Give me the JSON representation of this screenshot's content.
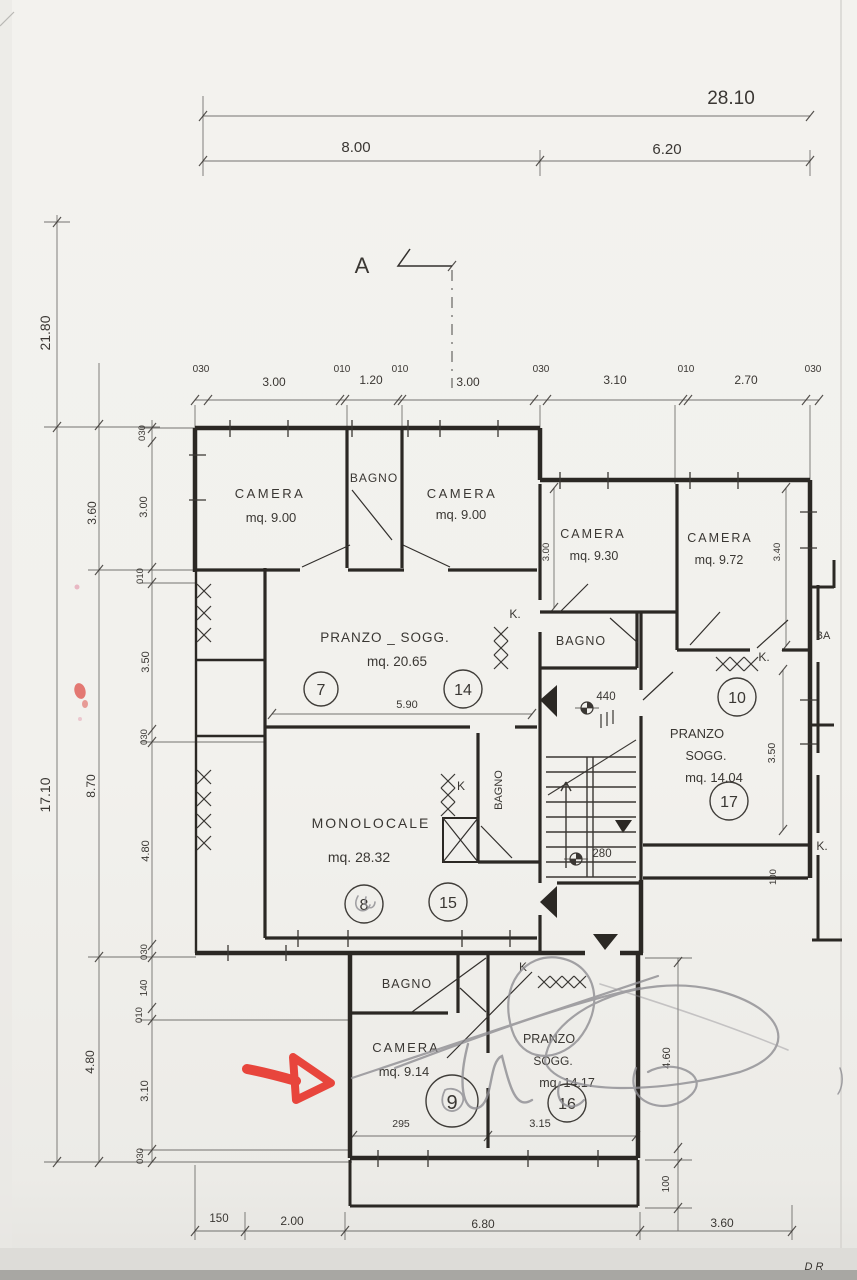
{
  "document": {
    "kind": "Scanned hand-drawn architectural floor plan",
    "language": "Italian"
  },
  "section_marker": "A",
  "dims_top": {
    "total": "28.10",
    "seg_left": "8.00",
    "seg_right": "6.20"
  },
  "dims_top_row": [
    "030",
    "3.00",
    "010",
    "1.20",
    "010",
    "3.00",
    "030",
    "3.10",
    "010",
    "2.70",
    "030"
  ],
  "dims_left_outer": [
    "21.80",
    "17.10"
  ],
  "dims_left_mid": [
    "3.60",
    "8.70",
    "4.80"
  ],
  "dims_left_inner": [
    "030",
    "3.00",
    "010",
    "3.50",
    "030",
    "4.80",
    "030",
    "140",
    "010",
    "3.10",
    "030"
  ],
  "dims_bottom": [
    "150",
    "2.00",
    "6.80",
    "3.60"
  ],
  "dims_right": {
    "camera_ne_h": "3.00",
    "camera_e_h": "3.40",
    "pranzo_e_h": "3.50",
    "strip_h": "100",
    "unit_s_h": "4.60",
    "balcony_s_h": "100"
  },
  "dims_interior": {
    "pranzo_width": "5.90",
    "stair_marker_1": "440",
    "stair_marker_2": "280",
    "camera_s_width": "295",
    "pranzo_s_width": "3.15"
  },
  "rooms": {
    "camera_nw": {
      "name": "CAMERA",
      "area": "mq. 9.00"
    },
    "bagno_n": {
      "name": "BAGNO"
    },
    "camera_n2": {
      "name": "CAMERA",
      "area": "mq. 9.00"
    },
    "camera_ne": {
      "name": "CAMERA",
      "area": "mq. 9.30"
    },
    "camera_e": {
      "name": "CAMERA",
      "area": "mq. 9.72"
    },
    "pranzo_sogg_main": {
      "name": "PRANZO _ SOGG.",
      "area": "mq. 20.65"
    },
    "bagno_center": {
      "name": "BAGNO"
    },
    "monolocale": {
      "name": "MONOLOCALE",
      "area": "mq. 28.32"
    },
    "bagno_monolocale": {
      "name": "BAGNO"
    },
    "pranzo_sogg_e": {
      "name_line1": "PRANZO",
      "name_line2": "SOGG.",
      "area": "mq. 14.04"
    },
    "bagno_s": {
      "name": "BAGNO"
    },
    "camera_s": {
      "name": "CAMERA",
      "area": "mq. 9.14"
    },
    "pranzo_sogg_s": {
      "name_line1": "PRANZO",
      "name_line2": "SOGG.",
      "area": "mq. 14.17"
    },
    "bagno_right_partial": {
      "name": "BA"
    }
  },
  "kitchen_labels": {
    "pranzo_main": "K.",
    "ne": "K.",
    "monolocale": "K",
    "right_edge": "K.",
    "south": "K"
  },
  "unit_numbers": {
    "pranzo_main": "7",
    "pranzo_14": "14",
    "monolocale": "8",
    "mono_15": "15",
    "ne_10": "10",
    "ne_17": "17",
    "south_9": "9",
    "south_16": "16"
  },
  "handwritten": {
    "initials": "D R"
  },
  "colors": {
    "red_marker": "#e8453c",
    "ink": "#3a3733",
    "pencil": "#8e8d92",
    "paper": "#f2f1ed"
  }
}
